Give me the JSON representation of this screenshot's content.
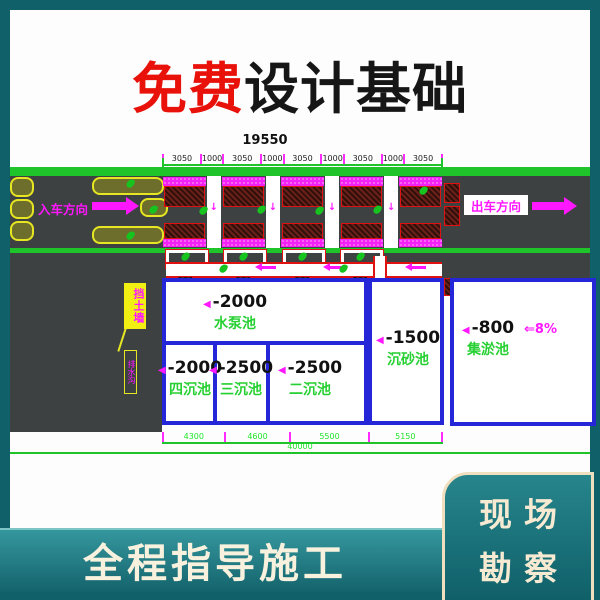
{
  "title": {
    "highlight": "免费",
    "rest": "设计基础"
  },
  "footer": {
    "band_text": "全程指导施工",
    "corner": {
      "line1": "现场",
      "line2": "勘察"
    }
  },
  "drawing": {
    "overall_top_dim": "19550",
    "top_segments": [
      "3050",
      "1000",
      "3050",
      "1000",
      "3050",
      "1000",
      "3050",
      "1000",
      "3050"
    ],
    "entry_label": "入车方向",
    "exit_label": "出车方向",
    "wall_label": "挡土墙",
    "trench_label": "排水沟",
    "slope_label": "⇐8%",
    "marker": "◀",
    "down_arrow": "↓",
    "pools": {
      "pump": {
        "depth": "-2000",
        "name": "水泵池"
      },
      "fourth": {
        "depth": "-2000",
        "name": "四沉池"
      },
      "third": {
        "depth": "-2500",
        "name": "三沉池"
      },
      "second": {
        "depth": "-2500",
        "name": "二沉池"
      },
      "sand": {
        "depth": "-1500",
        "name": "沉砂池"
      },
      "sludge": {
        "depth": "-800",
        "name": "集淤池"
      }
    },
    "bottom_dims": [
      "4300",
      "4600",
      "5500",
      "5150"
    ],
    "overall_bottom_dim": "40000"
  },
  "colors": {
    "page_teal": "#0f6069",
    "title_red": "#e8120a",
    "cad_green": "#1fc32a",
    "cad_magenta": "#ff17ff",
    "pool_blue": "#2526d8",
    "bay_red": "#e01111",
    "label_green": "#27d032",
    "cream": "#f6ead2"
  }
}
